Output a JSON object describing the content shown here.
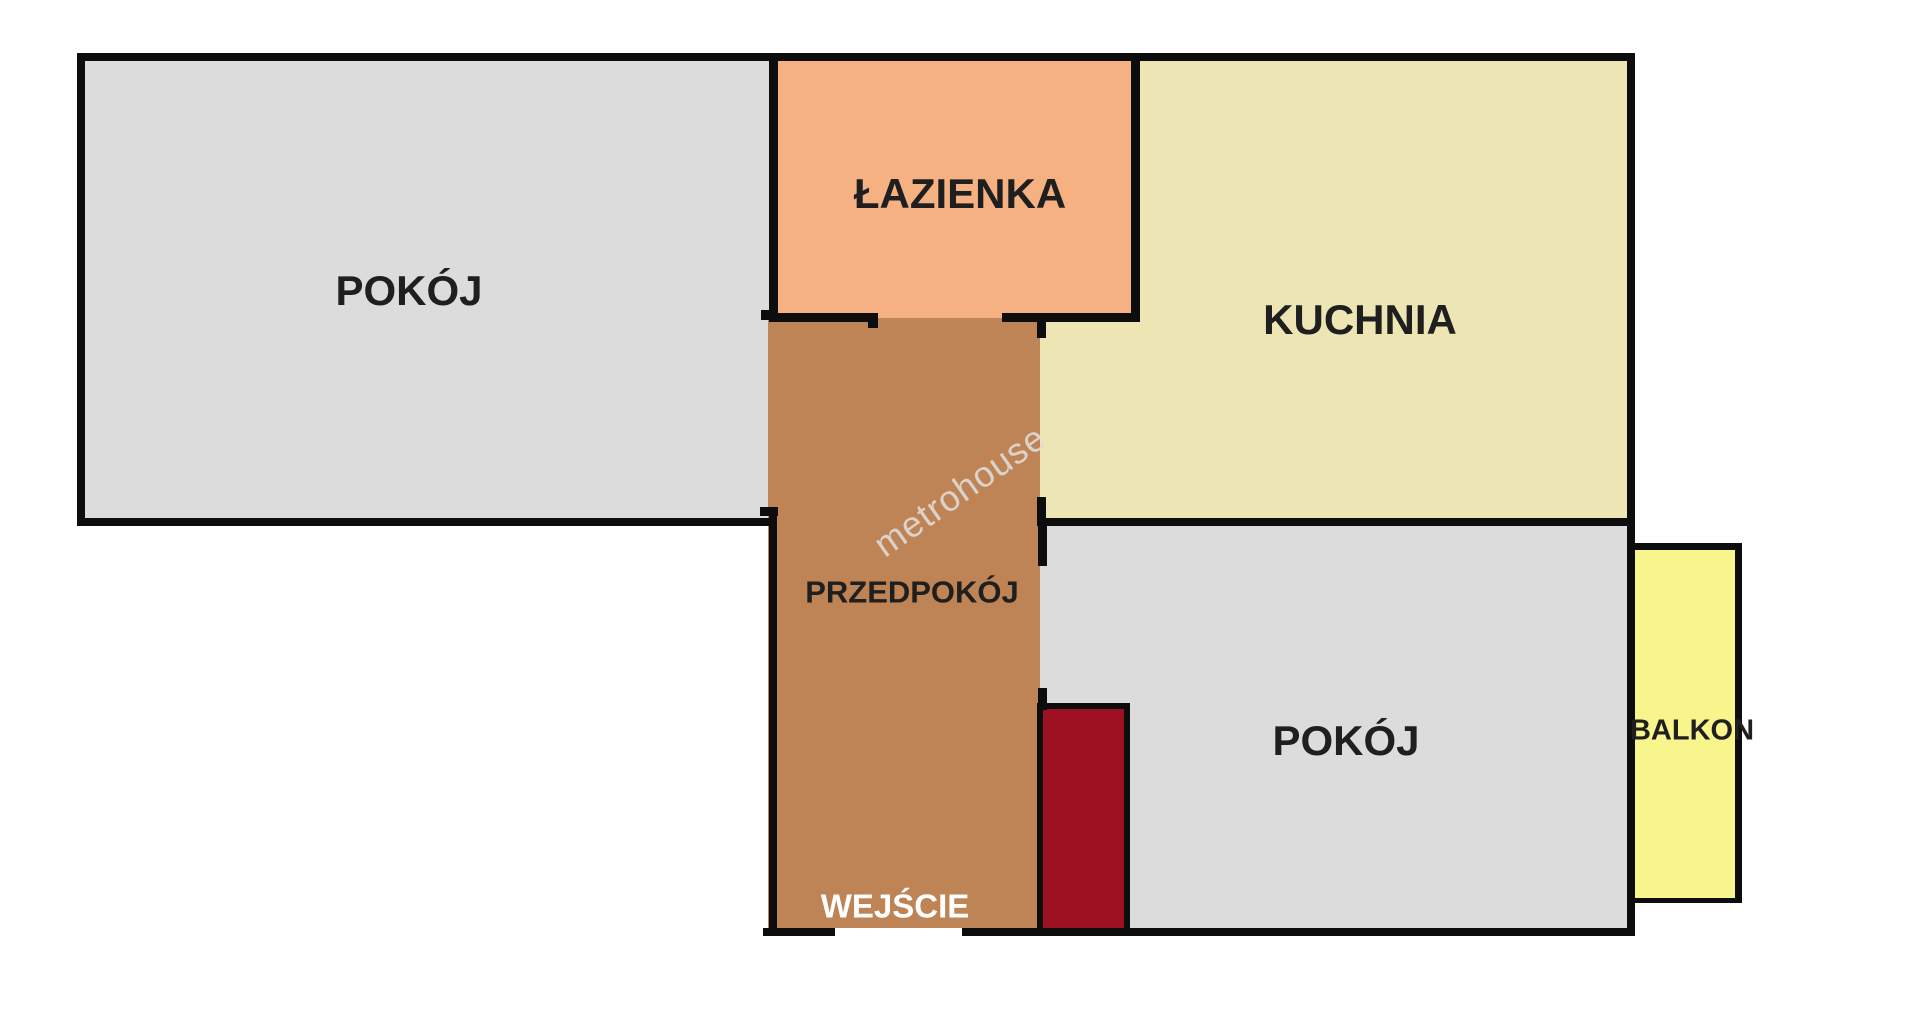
{
  "background": "#ffffff",
  "walls": {
    "color": "#0d0d0d"
  },
  "rooms": {
    "living": {
      "label": "POKÓJ",
      "fill": "#dcdcdc"
    },
    "bathroom": {
      "label": "ŁAZIENKA",
      "fill": "#f6b183"
    },
    "kitchen": {
      "label": "KUCHNIA",
      "fill": "#ede5b4"
    },
    "hallway": {
      "label": "PRZEDPOKÓJ",
      "fill": "#be8455"
    },
    "bedroom": {
      "label": "POKÓJ",
      "fill": "#dcdcdc"
    },
    "balcony": {
      "label": "BALKON",
      "fill": "#f8f58c"
    }
  },
  "entrance": {
    "label": "WEJŚCIE",
    "text_color": "#ffffff"
  },
  "wardrobe": {
    "fill": "#9d1021"
  },
  "watermark": {
    "text": "metrohouse",
    "color": "#dedbd8",
    "rotation_deg": -35
  }
}
